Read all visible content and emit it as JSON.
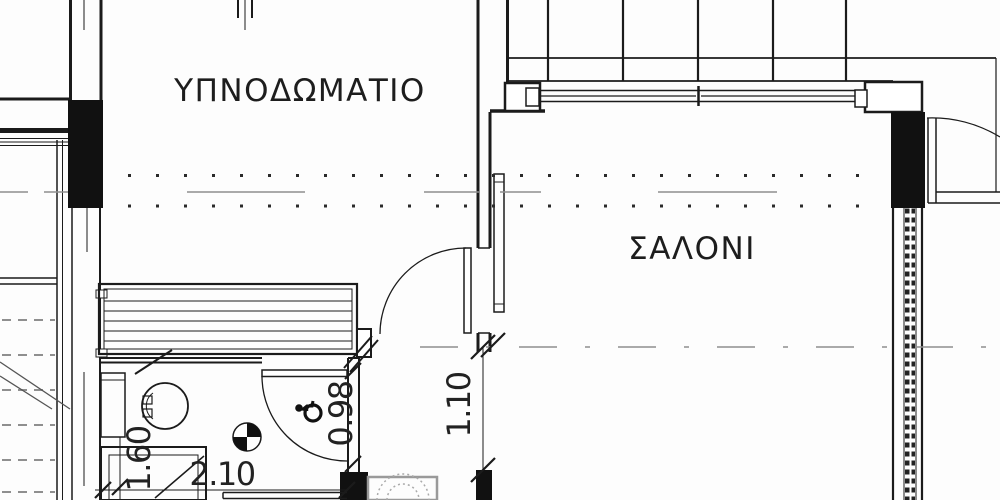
{
  "plan": {
    "type": "architectural-floor-plan",
    "bedroom_label": "ΥΠΝΟΔΩΜΑΤΙΟ",
    "living_label": "ΣΑΛΟΝΙ",
    "dims": {
      "bath_depth": "1.60",
      "bath_width": "2.10",
      "bath_door": "0.98",
      "passage": "1.10"
    },
    "icons": {
      "accessible": "wheelchair-icon",
      "datum": "quadrant-datum-marker"
    },
    "colors": {
      "line": "#1b1b1b",
      "gray": "#8f8f8f",
      "dots": "#2a2a2a"
    }
  }
}
